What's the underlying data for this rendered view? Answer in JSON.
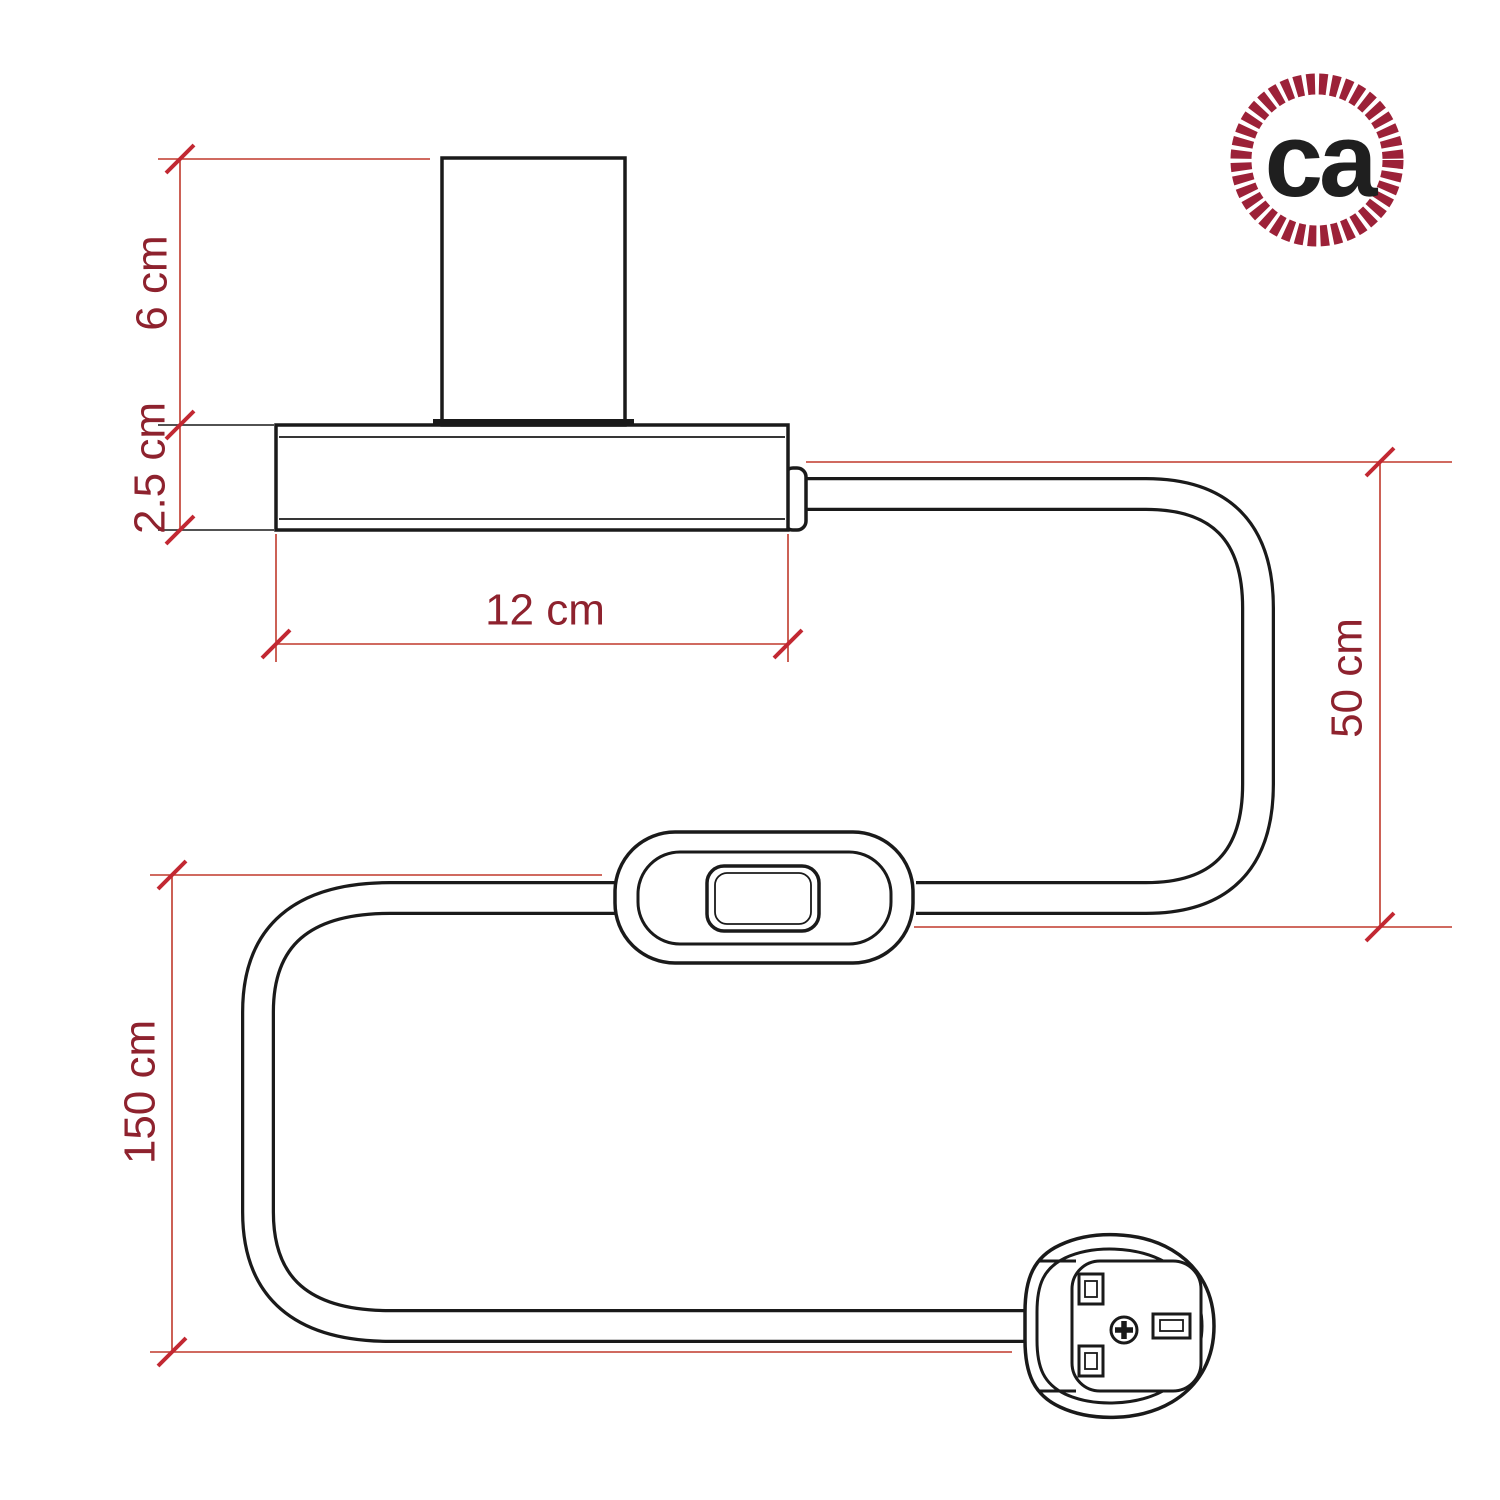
{
  "diagram": {
    "type": "product-dimension-drawing",
    "parts": [
      {
        "name": "lamp-holder-cylinder"
      },
      {
        "name": "lamp-base"
      },
      {
        "name": "power-cable"
      },
      {
        "name": "inline-switch"
      },
      {
        "name": "uk-plug"
      }
    ],
    "dimensions": [
      {
        "id": "holder-height",
        "label": "6 cm",
        "measures": "lamp holder height",
        "orientation": "vertical"
      },
      {
        "id": "base-height",
        "label": "2.5 cm",
        "measures": "base thickness",
        "orientation": "vertical"
      },
      {
        "id": "base-width",
        "label": "12 cm",
        "measures": "base width",
        "orientation": "horizontal"
      },
      {
        "id": "cable-upper",
        "label": "50 cm",
        "measures": "cable from base to switch",
        "orientation": "vertical"
      },
      {
        "id": "cable-lower",
        "label": "150 cm",
        "measures": "cable from switch to plug",
        "orientation": "vertical"
      }
    ],
    "logo": {
      "text": "ca"
    },
    "colors": {
      "background": "#ffffff",
      "outline": "#1a1a1a",
      "dimension_line": "#c0392b",
      "dimension_text": "#8e222e",
      "tick": "#c22832",
      "logo_ring": "#9c2138",
      "logo_text": "#1f1f1f"
    }
  }
}
